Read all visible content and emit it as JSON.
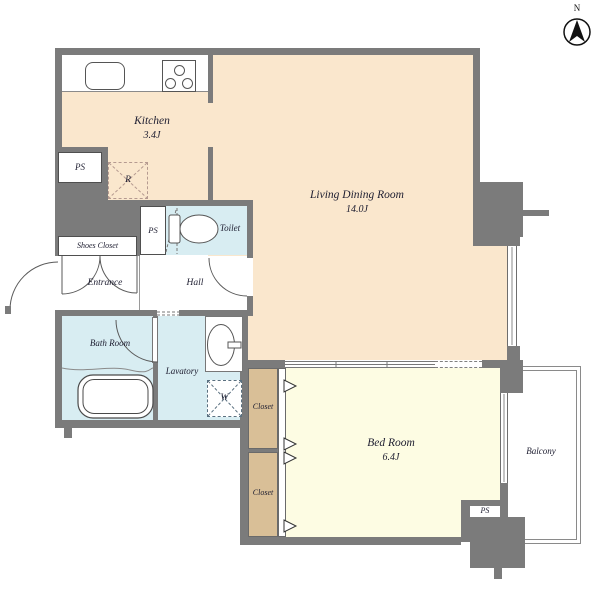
{
  "compass": {
    "label": "N"
  },
  "rooms": {
    "kitchen": {
      "name": "Kitchen",
      "size": "3.4J"
    },
    "living_dining": {
      "name": "Living Dining Room",
      "size": "14.0J"
    },
    "bed_room": {
      "name": "Bed Room",
      "size": "6.4J"
    },
    "balcony": {
      "name": "Balcony"
    },
    "bath_room": {
      "name": "Bath Room"
    },
    "lavatory": {
      "name": "Lavatory"
    },
    "toilet": {
      "name": "Toilet"
    },
    "hall": {
      "name": "Hall"
    },
    "entrance": {
      "name": "Entrance"
    },
    "shoes_closet": {
      "name": "Shoes Closet"
    },
    "closet_upper": {
      "name": "Closet"
    },
    "closet_lower": {
      "name": "Closet"
    }
  },
  "fixtures": {
    "ps_kitchen": "PS",
    "ps_toilet": "PS",
    "ps_bedroom": "PS",
    "refrigerator_label": "R",
    "washing_machine_label": "W"
  },
  "colors": {
    "wall": "#7b7b7b",
    "kitchen_living_floor": "#fae7cd",
    "bedroom_floor": "#fdfce3",
    "closet_floor": "#d9bf97",
    "wet_area_floor": "#d8edf2",
    "outline": "#4f4f4f"
  }
}
